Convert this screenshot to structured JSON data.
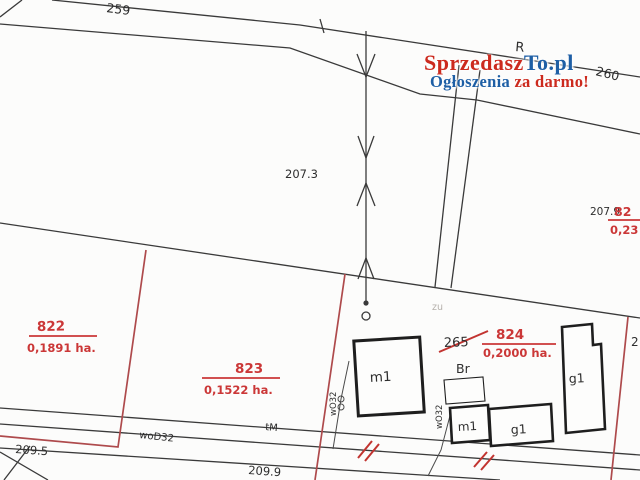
{
  "watermark": {
    "brand_red": "Sprzedasz",
    "brand_blue": "To.pl",
    "tagline_blue": "Ogłoszenia ",
    "tagline_red": "za darmo!"
  },
  "map": {
    "road_labels": {
      "n259": "259",
      "n260": "260",
      "n209_5": "209.5",
      "n209_9": "209.9"
    },
    "parcel_labels": {
      "p822": {
        "num": "822",
        "area": "0,1891 ha."
      },
      "p823": {
        "num": "823",
        "area": "0,1522 ha."
      },
      "p824": {
        "num": "824",
        "area": "0,2000 ha."
      },
      "p825_clipped": {
        "num": "82",
        "area": "0,23"
      }
    },
    "land_labels": {
      "n207_3": "207.3",
      "n207_9": "207.9",
      "r_class": "R",
      "br_class": "Br",
      "zu_class": "zu",
      "old_265": "265",
      "n2_clipped": "2"
    },
    "building_labels": {
      "m1_big": "m1",
      "m1_small": "m1",
      "g1_small": "g1",
      "g1_tall": "g1"
    },
    "utility_labels": {
      "wod32": "woD32",
      "wo32_a": "wO32",
      "wo32_b": "wO32",
      "tm": "tM"
    }
  },
  "colors": {
    "line_black": "#3a3a3a",
    "boundary_red": "#ae4a4c",
    "label_red": "#cb3737",
    "hatch_red": "#c23430",
    "brand_red": "#cc2a1e",
    "brand_blue": "#1e5fa5"
  }
}
